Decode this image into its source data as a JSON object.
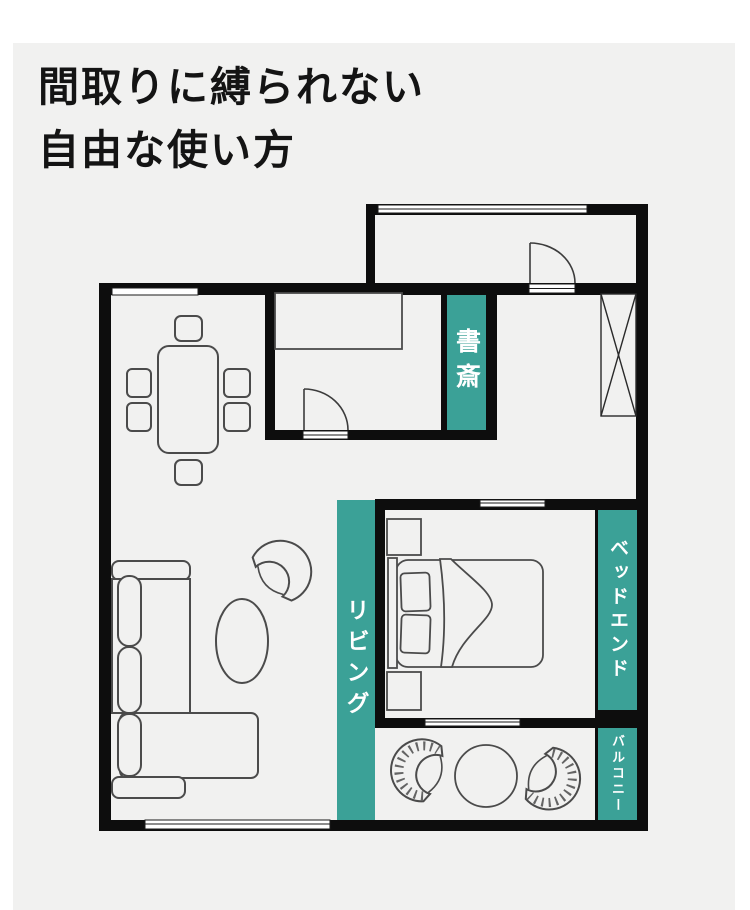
{
  "page": {
    "background": "#ffffff",
    "panel_color": "#f1f1f0"
  },
  "title": {
    "line1": "間取りに縛られない",
    "line2": "自由な使い方",
    "color": "#141414"
  },
  "floorplan": {
    "wall_color": "#0d0d0d",
    "accent_color": "#3ba197",
    "label_text_color": "#ffffff",
    "furniture_stroke": "#4b4b4b",
    "window_fill": "#ffffff",
    "labels": {
      "study": "書斎",
      "living": "リビング",
      "bed_end": "ベッドエンド",
      "balcony": "バルコニー"
    },
    "furniture_icons": [
      "dining-table-icon",
      "dining-chair-icon",
      "kitchen-counter-icon",
      "door-swing-icon",
      "closet-x-icon",
      "sofa-icon",
      "coffee-table-icon",
      "armchair-icon",
      "double-bed-icon",
      "pillow-icon",
      "nightstand-icon",
      "balcony-chair-icon",
      "balcony-table-icon",
      "window-icon"
    ]
  }
}
